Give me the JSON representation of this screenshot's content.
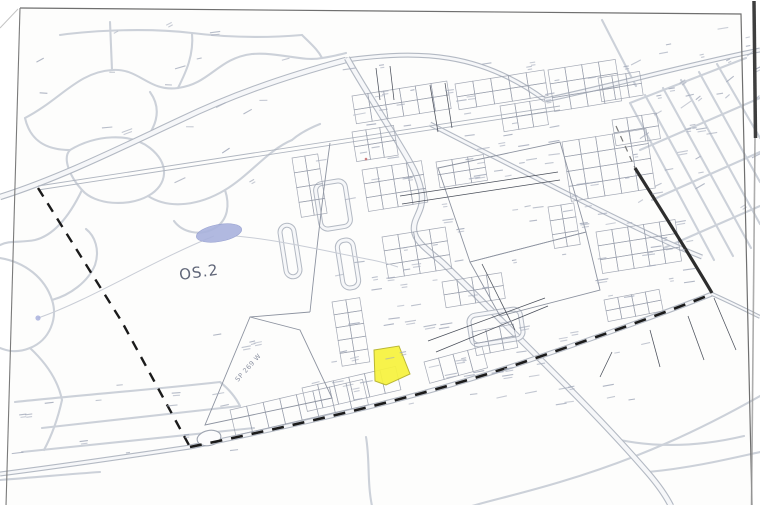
{
  "page": {
    "background": "#fdfdfc",
    "frame_color": "#6f6f6f"
  },
  "map": {
    "labels": {
      "os_zone": "OS.2",
      "secondary_plan": "SP 269 W"
    },
    "colors": {
      "highlight_parcel": "#f7f33d",
      "highlight_edge": "#b5b225",
      "pond": "#a9b2dd",
      "boundary_dash": "#1b1b1b",
      "street": "#ccd1d9",
      "parcel_line": "#9aa0ad",
      "road_edge": "#b3b9c3",
      "label_ink": "#606678"
    }
  }
}
